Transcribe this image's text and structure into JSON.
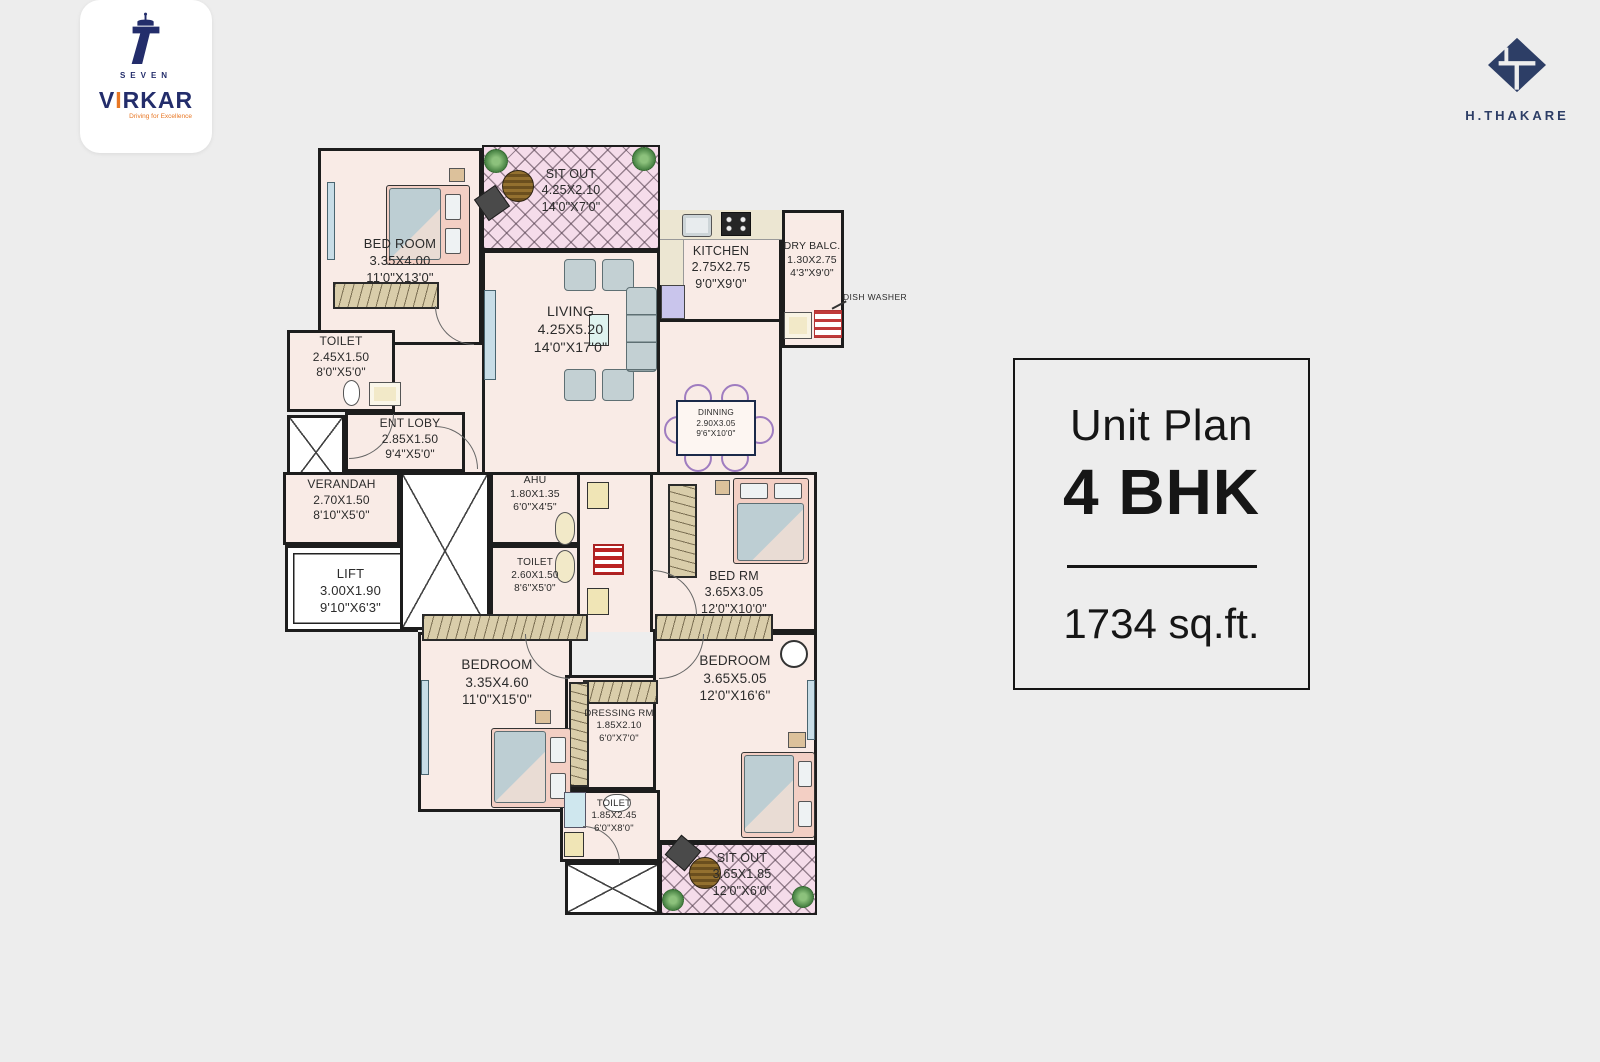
{
  "page": {
    "background": "#ededed"
  },
  "branding": {
    "virkar": {
      "seven": "SEVEN",
      "name_v": "V",
      "name_i": "I",
      "name_rest": "RKAR",
      "tagline": "Driving for Excellence"
    },
    "thakare": {
      "name": "H.THAKARE"
    }
  },
  "unit_panel": {
    "title": "Unit Plan",
    "unit_type": "4 BHK",
    "area": "1734 sq.ft."
  },
  "plan": {
    "annotations": {
      "dish_washer": "DISH WASHER"
    },
    "rooms": [
      {
        "name": "BED ROOM",
        "dim_m": "3.35X4.00",
        "dim_ft": "11'0\"X13'0\""
      },
      {
        "name": "SIT OUT",
        "dim_m": "4.25X2.10",
        "dim_ft": "14'0\"X7'0\""
      },
      {
        "name": "KITCHEN",
        "dim_m": "2.75X2.75",
        "dim_ft": "9'0\"X9'0\""
      },
      {
        "name": "DRY BALC.",
        "dim_m": "1.30X2.75",
        "dim_ft": "4'3\"X9'0\""
      },
      {
        "name": "LIVING",
        "dim_m": "4.25X5.20",
        "dim_ft": "14'0\"X17'0\""
      },
      {
        "name": "DINNING",
        "dim_m": "2.90X3.05",
        "dim_ft": "9'6\"X10'0\""
      },
      {
        "name": "TOILET",
        "dim_m": "2.45X1.50",
        "dim_ft": "8'0\"X5'0\""
      },
      {
        "name": "ENT LOBY",
        "dim_m": "2.85X1.50",
        "dim_ft": "9'4\"X5'0\""
      },
      {
        "name": "VERANDAH",
        "dim_m": "2.70X1.50",
        "dim_ft": "8'10\"X5'0\""
      },
      {
        "name": "LIFT",
        "dim_m": "3.00X1.90",
        "dim_ft": "9'10\"X6'3\""
      },
      {
        "name": "AHU",
        "dim_m": "1.80X1.35",
        "dim_ft": "6'0\"X4'5\""
      },
      {
        "name": "TOILET",
        "dim_m": "2.60X1.50",
        "dim_ft": "8'6\"X5'0\""
      },
      {
        "name": "BED RM",
        "dim_m": "3.65X3.05",
        "dim_ft": "12'0\"X10'0\""
      },
      {
        "name": "BEDROOM",
        "dim_m": "3.35X4.60",
        "dim_ft": "11'0\"X15'0\""
      },
      {
        "name": "DRESSING RM",
        "dim_m": "1.85X2.10",
        "dim_ft": "6'0\"X7'0\""
      },
      {
        "name": "BEDROOM",
        "dim_m": "3.65X5.05",
        "dim_ft": "12'0\"X16'6\""
      },
      {
        "name": "TOILET",
        "dim_m": "1.85X2.45",
        "dim_ft": "6'0\"X8'0\""
      },
      {
        "name": "SIT OUT",
        "dim_m": "3.65X1.85",
        "dim_ft": "12'0\"X6'0\""
      }
    ],
    "colors": {
      "floor": "#f9ebe6",
      "wall": "#1d1d1d",
      "sitout": "#f5dcea",
      "wardrobe": "#d9cdaa",
      "counter": "#ece6d2",
      "navy": "#232d6b",
      "thakare_navy": "#2d3e66",
      "accent_orange": "#e87724"
    }
  }
}
